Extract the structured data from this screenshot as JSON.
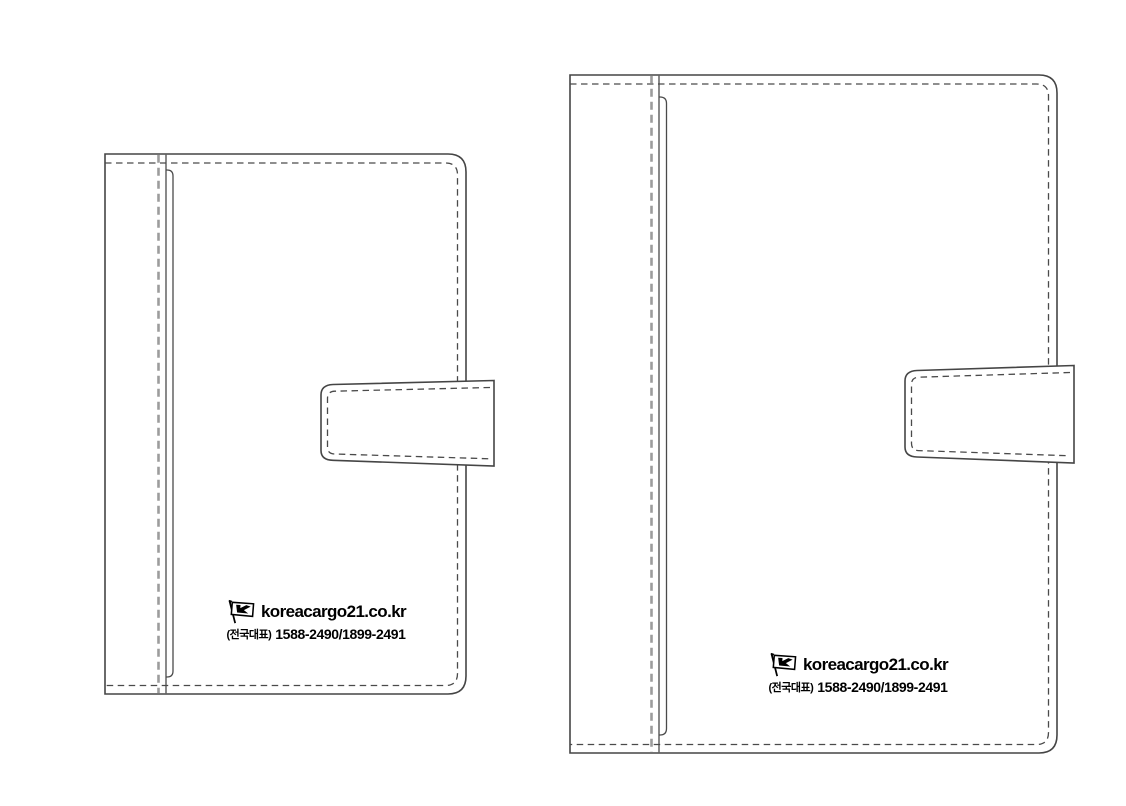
{
  "canvas": {
    "width": 1126,
    "height": 806,
    "background": "#ffffff"
  },
  "colors": {
    "outline": "#454545",
    "stitch_dash": "#4a4a4a",
    "fold_dash": "#9c9c9c",
    "fill": "#ffffff",
    "text": "#000000"
  },
  "covers": [
    {
      "id": "small-cover",
      "brand": {
        "icon": "korea-cargo-flag-icon",
        "domain": "koreacargo21.co.kr",
        "phone_label": "(전국대표)",
        "phone_numbers": "1588-2490/1899-2491"
      }
    },
    {
      "id": "large-cover",
      "brand": {
        "icon": "korea-cargo-flag-icon",
        "domain": "koreacargo21.co.kr",
        "phone_label": "(전국대표)",
        "phone_numbers": "1588-2490/1899-2491"
      }
    }
  ]
}
